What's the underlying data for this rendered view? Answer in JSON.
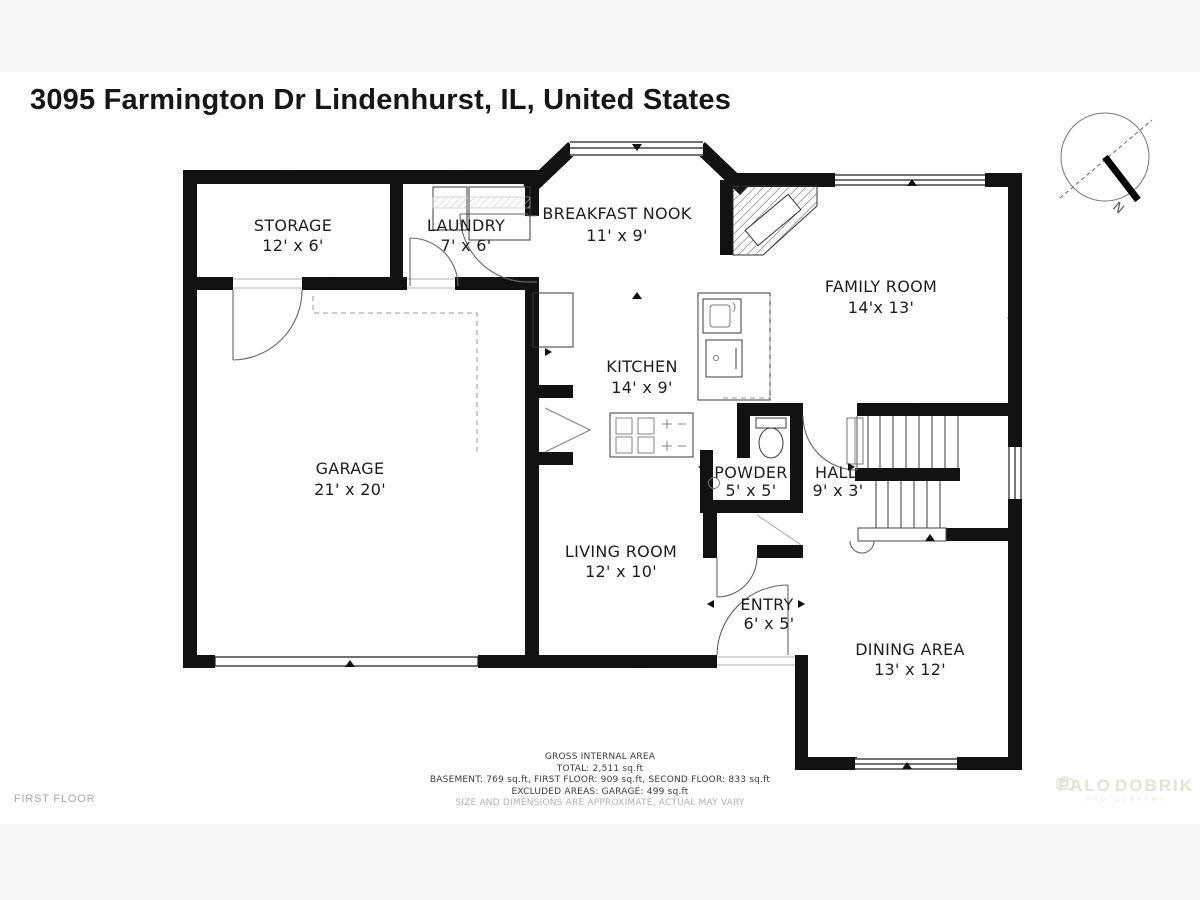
{
  "title": "3095 Farmington Dr Lindenhurst, IL, United States",
  "floor_label": "FIRST FLOOR",
  "compass": {
    "north_label": "N"
  },
  "rooms": [
    {
      "name": "STORAGE",
      "dims": "12' x 6'"
    },
    {
      "name": "LAUNDRY",
      "dims": "7' x 6'"
    },
    {
      "name": "BREAKFAST NOOK",
      "dims": "11' x 9'"
    },
    {
      "name": "FAMILY ROOM",
      "dims": "14'x 13'"
    },
    {
      "name": "KITCHEN",
      "dims": "14' x 9'"
    },
    {
      "name": "GARAGE",
      "dims": "21' x 20'"
    },
    {
      "name": "POWDER",
      "dims": "5' x 5'"
    },
    {
      "name": "HALL",
      "dims": "9' x 3'"
    },
    {
      "name": "LIVING ROOM",
      "dims": "12' x 10'"
    },
    {
      "name": "ENTRY",
      "dims": "6' x 5'"
    },
    {
      "name": "DINING AREA",
      "dims": "13' x 12'"
    }
  ],
  "footer": {
    "line1": "GROSS INTERNAL AREA",
    "line2": "TOTAL: 2,511 sq.ft",
    "line3": "BASEMENT: 769 sq.ft, FIRST FLOOR: 909 sq.ft, SECOND FLOOR: 833 sq.ft",
    "line4": "EXCLUDED AREAS: GARAGE: 499 sq.ft",
    "line5": "SIZE AND DIMENSIONS ARE APPROXIMATE, ACTUAL MAY VARY"
  },
  "watermark": {
    "brand_left": "PALO",
    "brand_right": "DOBRIK",
    "sub": "PHOTOGRAPHY"
  },
  "colors": {
    "wall": "#121212",
    "background": "#f5f4f6",
    "paper": "#ffffff",
    "label": "#1d1d1d",
    "muted": "#b3b1b1",
    "watermark": "#e7e1d6"
  }
}
